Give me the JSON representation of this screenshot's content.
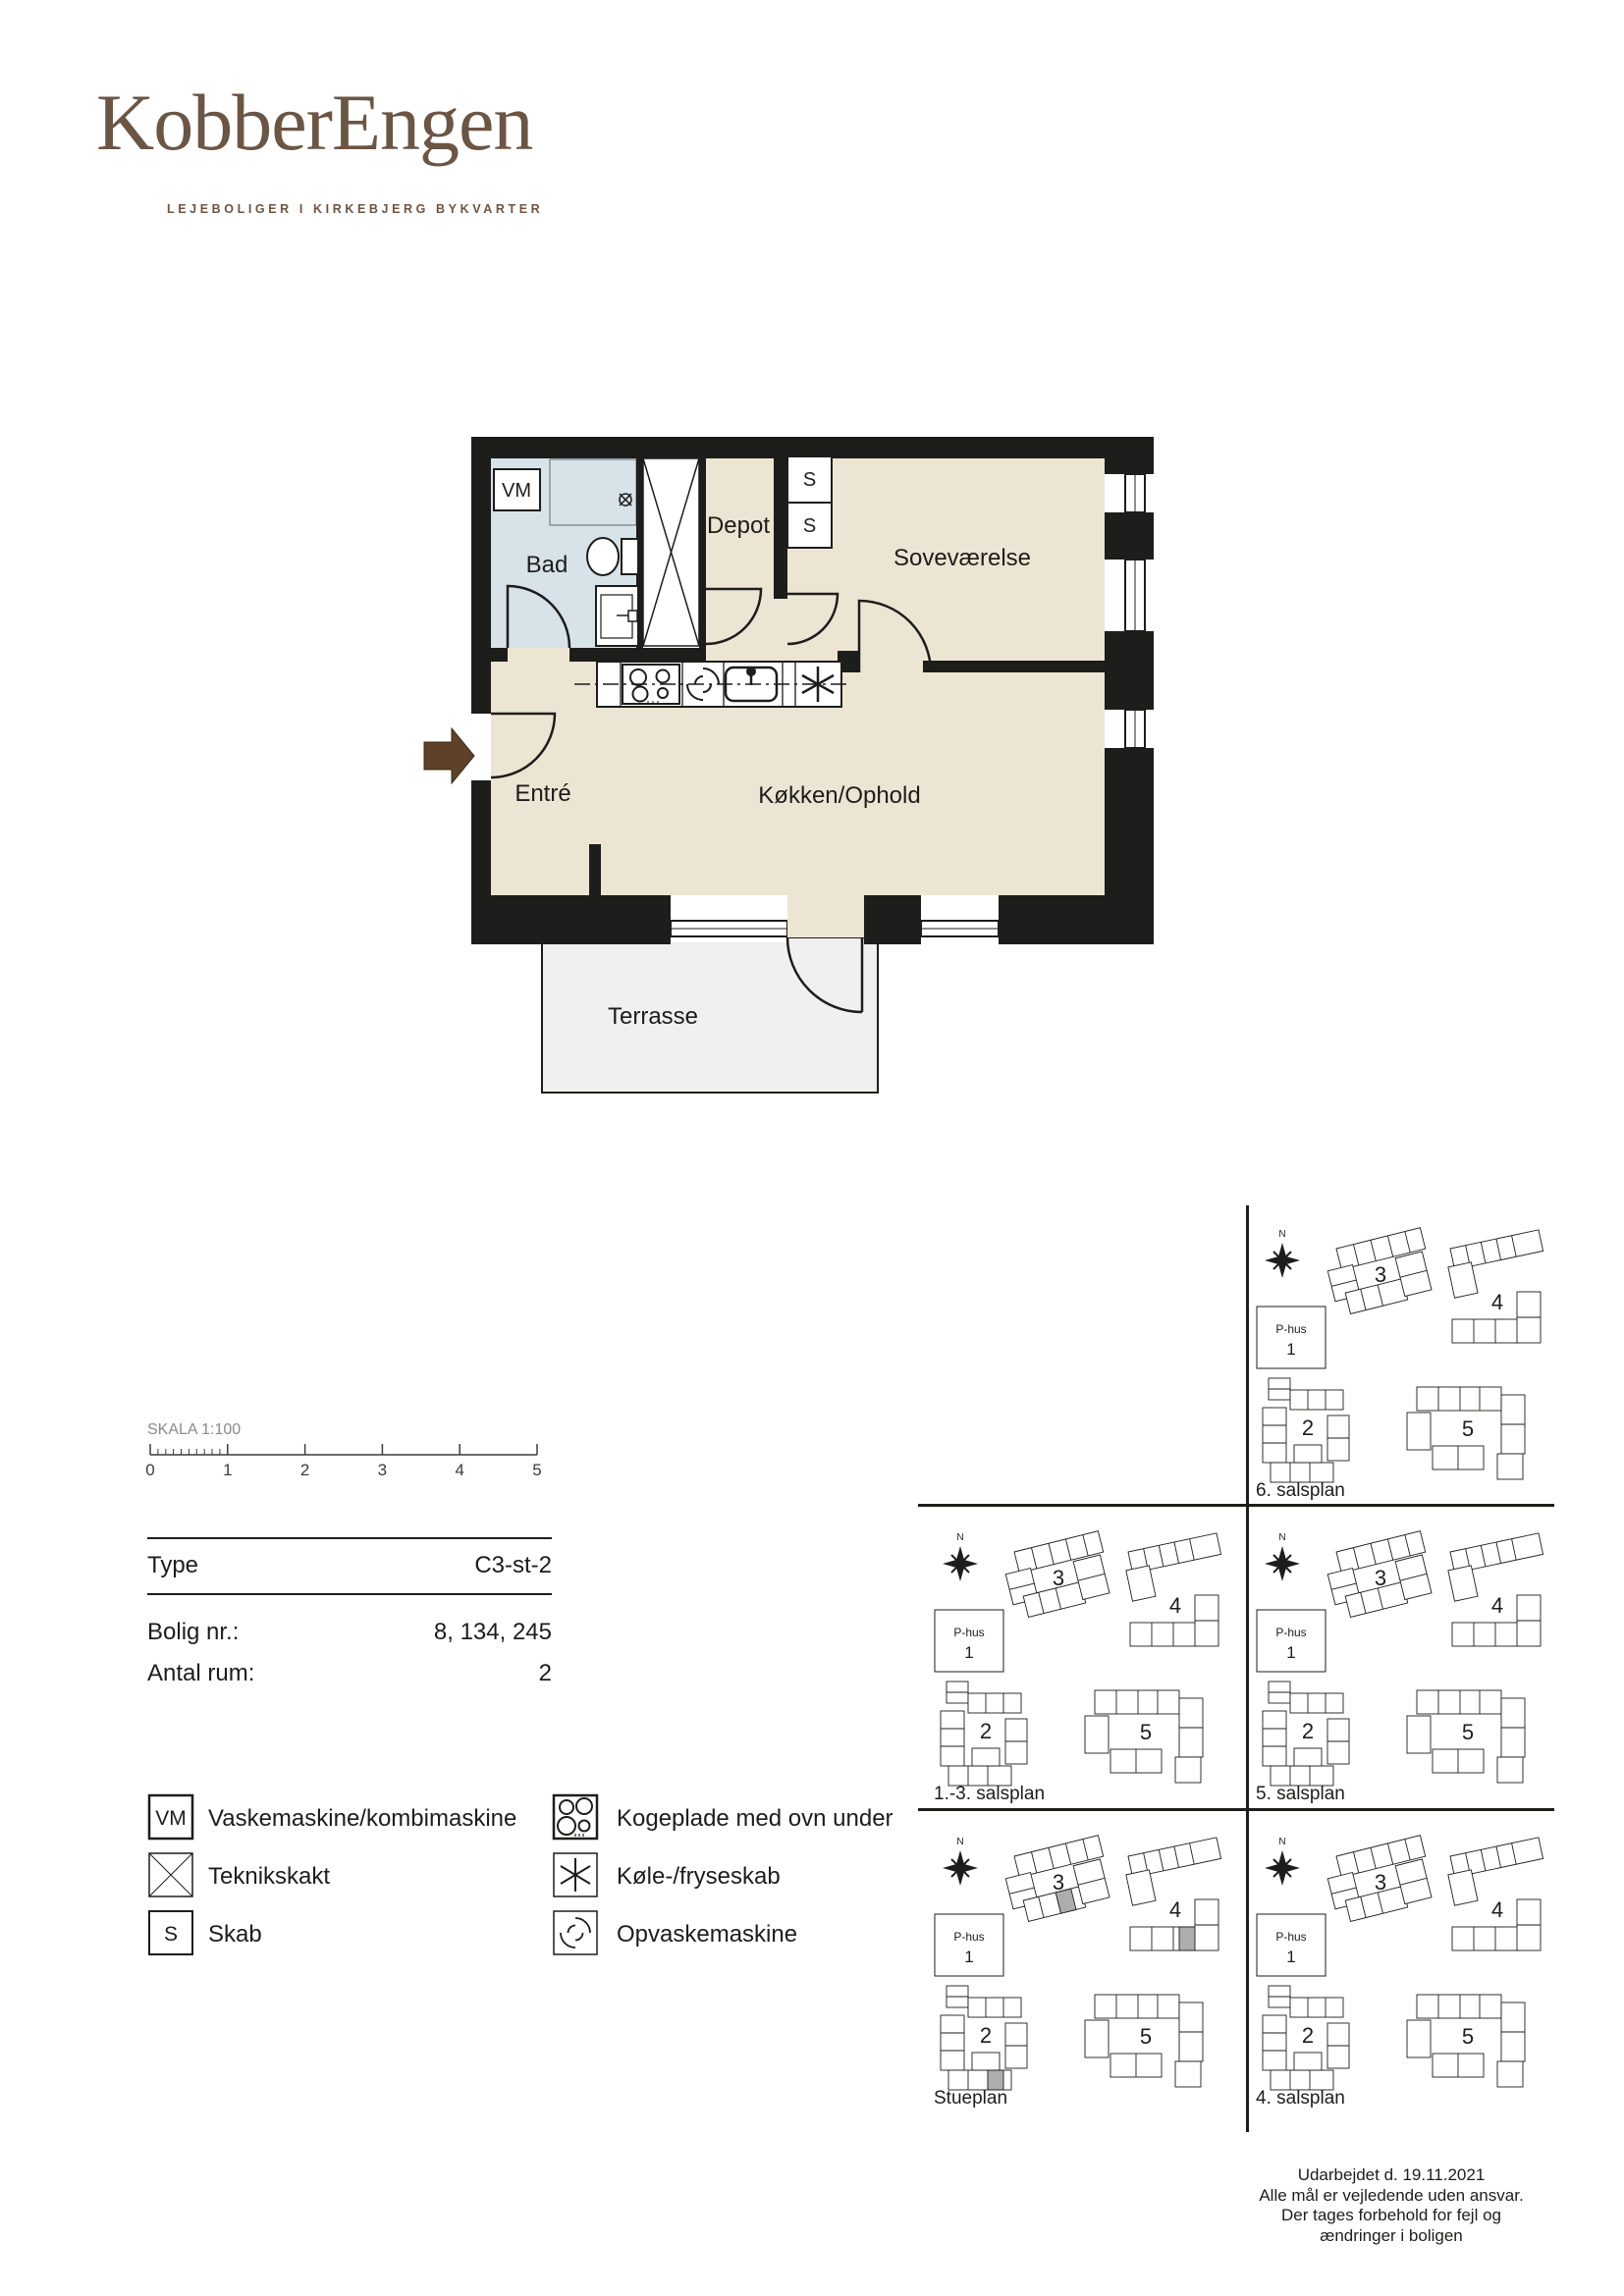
{
  "brand": {
    "logo": "KobberEngen",
    "tagline": "LEJEBOLIGER I KIRKEBJERG BYKVARTER",
    "color": "#6b5544"
  },
  "floorplan": {
    "rooms": {
      "bath": "Bad",
      "vm": "VM",
      "depot": "Depot",
      "closet1": "S",
      "closet2": "S",
      "bedroom": "Soveværelse",
      "entry": "Entré",
      "kitchen": "Køkken/Ophold",
      "terrace": "Terrasse"
    },
    "colors": {
      "wall": "#1d1d1b",
      "floor": "#ede5d3",
      "bath_floor": "#d7e2e9",
      "terrace_floor": "#f1f0ee",
      "entry_arrow": "#5e4128"
    }
  },
  "scalebar": {
    "title": "SKALA 1:100",
    "ticks": [
      "0",
      "1",
      "2",
      "3",
      "4",
      "5"
    ]
  },
  "infotable": {
    "rows": [
      {
        "label": "Type",
        "value": "C3-st-2"
      },
      {
        "label": "Bolig nr.:",
        "value": "8, 134, 245"
      },
      {
        "label": "Antal rum:",
        "value": "2"
      }
    ]
  },
  "legend": {
    "vm_glyph": "VM",
    "s_glyph": "S",
    "items_left": [
      {
        "icon": "vm-box-icon",
        "label": "Vaskemaskine/kombimaskine"
      },
      {
        "icon": "technical-shaft-icon",
        "label": "Teknikskakt"
      },
      {
        "icon": "cabinet-icon",
        "label": "Skab"
      }
    ],
    "items_right": [
      {
        "icon": "cooktop-icon",
        "label": "Kogeplade med ovn under"
      },
      {
        "icon": "fridge-freezer-icon",
        "label": "Køle-/fryseskab"
      },
      {
        "icon": "dishwasher-icon",
        "label": "Opvaskemaskine"
      }
    ]
  },
  "siteplans": {
    "north": "N",
    "phus_line1": "P-hus",
    "phus_line2": "1",
    "buildings": {
      "b2": "2",
      "b3": "3",
      "b4": "4",
      "b5": "5"
    },
    "panels": [
      {
        "label": "6. salsplan",
        "highlighted": false
      },
      {
        "label": "1.-3. salsplan",
        "highlighted": false
      },
      {
        "label": "5. salsplan",
        "highlighted": false
      },
      {
        "label": "Stueplan",
        "highlighted": true
      },
      {
        "label": "4. salsplan",
        "highlighted": false
      }
    ]
  },
  "footer": {
    "lines": [
      "Udarbejdet d. 19.11.2021",
      "Alle mål er vejledende uden ansvar.",
      "Der tages forbehold for fejl og",
      "ændringer i boligen"
    ]
  }
}
